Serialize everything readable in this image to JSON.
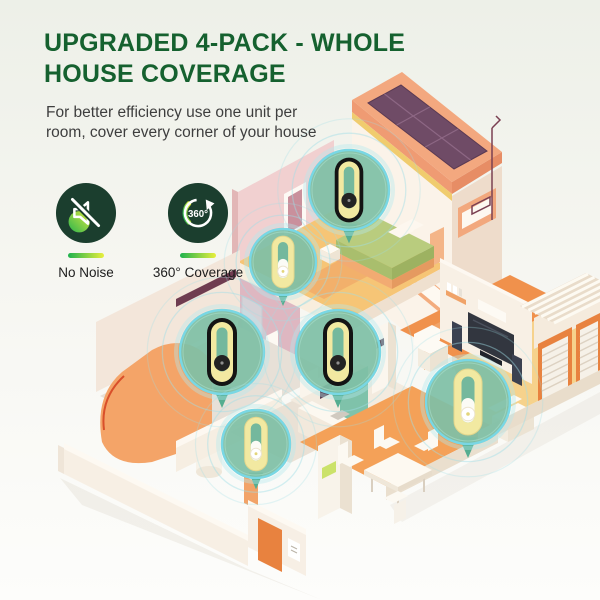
{
  "header": {
    "title_lines": [
      "UPGRADED 4-PACK - WHOLE",
      "HOUSE COVERAGE"
    ],
    "title_color": "#15612f",
    "subtitle_lines": [
      "For better efficiency use one unit per",
      "room, cover every corner of your house"
    ]
  },
  "badges": [
    {
      "id": "no-noise",
      "icon": "muted-speaker-icon",
      "label": "No Noise"
    },
    {
      "id": "360-coverage",
      "icon": "360-rotation-icon",
      "icon_text": "360°",
      "label": "360° Coverage"
    }
  ],
  "accent": {
    "gradient_start": "#1eb24e",
    "gradient_end": "#e9ef3d",
    "icon_bg": "#1b3e2e"
  },
  "illustration": {
    "pins": [
      {
        "room": "bedroom",
        "x": 349,
        "y": 190,
        "r": 40,
        "variant": "dark"
      },
      {
        "room": "bathroom",
        "x": 283,
        "y": 262,
        "r": 33,
        "variant": "light"
      },
      {
        "room": "living-room",
        "x": 222,
        "y": 352,
        "r": 42,
        "variant": "dark"
      },
      {
        "room": "kitchen",
        "x": 338,
        "y": 352,
        "r": 42,
        "variant": "dark"
      },
      {
        "room": "hallway",
        "x": 256,
        "y": 444,
        "r": 34,
        "variant": "light"
      },
      {
        "room": "family-room",
        "x": 468,
        "y": 402,
        "r": 42,
        "variant": "light"
      }
    ],
    "colors": {
      "pin_fill": "#7fc0a6",
      "pin_hole": "#74b89d",
      "pin_ring": "#79d7e4",
      "pin_glow": "#b5e8ee",
      "ripple": "#9fdde6",
      "pin_tail": "#55ad90",
      "device_ring": "#f2e9a1",
      "device_dark": "#141414",
      "device_light": "#fbfbf5"
    }
  }
}
